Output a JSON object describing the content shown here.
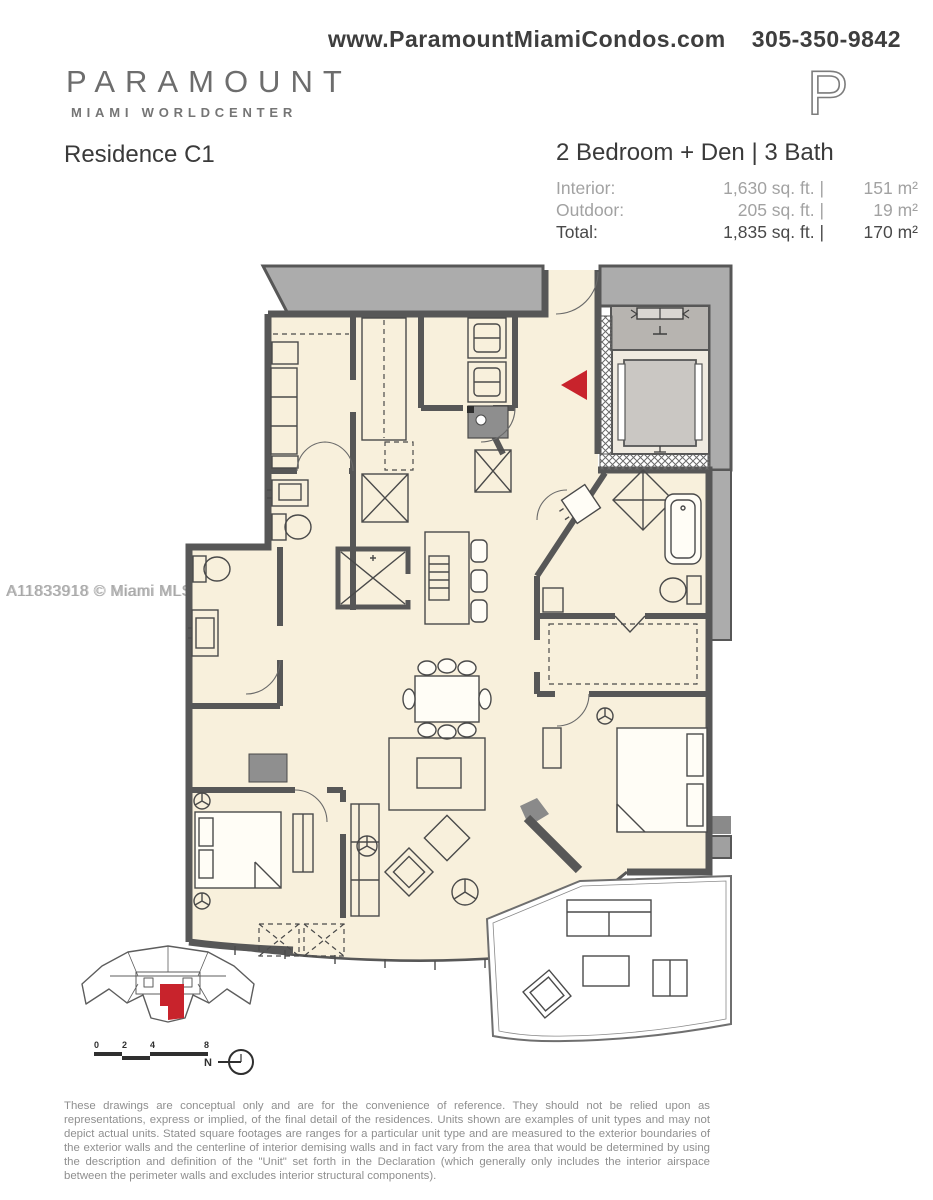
{
  "header": {
    "website": "www.ParamountMiamiCondos.com",
    "phone": "305-350-9842"
  },
  "brand": {
    "name": "PARAMOUNT",
    "subtitle": "MIAMI WORLDCENTER",
    "mark": "P"
  },
  "unit": {
    "residence": "Residence C1",
    "configuration": "2 Bedroom + Den | 3 Bath",
    "specs": [
      {
        "label": "Interior:",
        "sqft": "1,630 sq. ft. |",
        "metric": "151 m²",
        "emphasis": false
      },
      {
        "label": "Outdoor:",
        "sqft": "205 sq. ft. |",
        "metric": "19 m²",
        "emphasis": false
      },
      {
        "label": "Total:",
        "sqft": "1,835 sq. ft. |",
        "metric": "170 m²",
        "emphasis": true
      }
    ]
  },
  "watermark": {
    "text": "A11833918 © Miami MLS® 2025"
  },
  "floorplan": {
    "colors": {
      "floor": "#f8f0dc",
      "walls": "#575757",
      "common_corridor": "#acacac",
      "elevator_cab": "#cac7c3",
      "entry_marker": "#c8232c"
    },
    "entry_marker": "red-arrow-left"
  },
  "keyplan": {
    "highlight_color": "#c8232c"
  },
  "scale_bar": {
    "ticks": [
      "0",
      "2",
      "4",
      "8"
    ]
  },
  "compass": {
    "label": "N"
  },
  "disclaimer": {
    "text": "These drawings are conceptual only and are for the convenience of reference. They should not be relied upon as representations, express or implied, of the final detail of the residences. Units shown are examples of unit types and may not depict actual units. Stated square footages are ranges for a particular unit type and are measured to the exterior boundaries of the exterior walls and the centerline of interior demising walls and in fact vary from the area that would be determined by using the description and definition of the \"Unit\" set forth in the Declaration (which generally only includes the interior airspace between the perimeter walls and excludes interior structural components)."
  }
}
